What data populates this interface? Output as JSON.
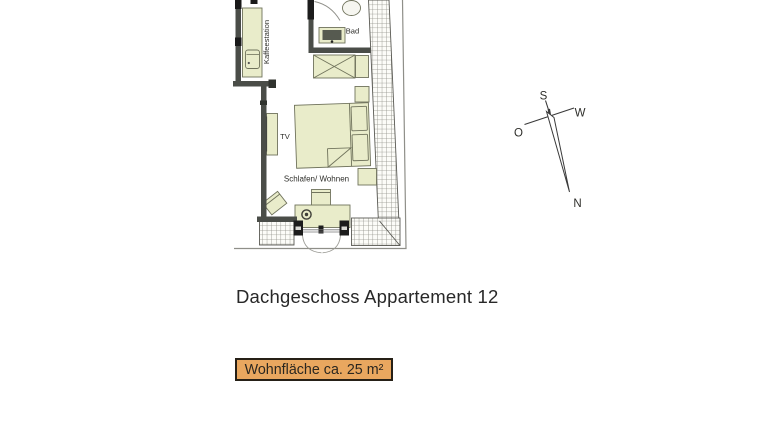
{
  "floor_plan": {
    "rooms": {
      "kaffeestation_label": "Kaffeestation",
      "bad_label": "Bad",
      "tv_label": "TV",
      "schlafen_wohnen_label": "Schlafen/ Wohnen"
    }
  },
  "compass": {
    "s": "S",
    "w": "W",
    "o": "O",
    "n": "N"
  },
  "caption": {
    "title": "Dachgeschoss Appartement 12"
  },
  "area_badge": {
    "label": "Wohnfläche ca. 25 m²"
  },
  "colors": {
    "wall": "#4a4d48",
    "wall_dark": "#1c1c1c",
    "furniture_fill": "#e9ecca",
    "furniture_outline": "#70735c",
    "hatch_line": "#8e8e86",
    "badge_background": "#e9a75f",
    "badge_border": "#262017"
  }
}
